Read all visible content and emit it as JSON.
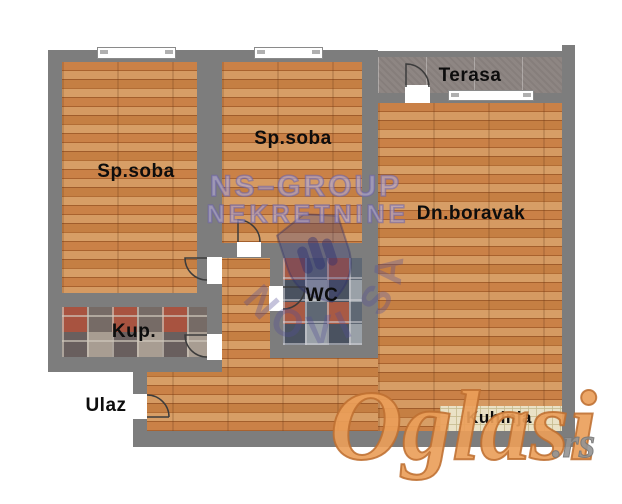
{
  "plan_title": "Apartment floor plan",
  "rooms": {
    "bedroom_left": "Sp.soba",
    "bedroom_middle": "Sp.soba",
    "terrace": "Terasa",
    "living_room": "Dn.boravak",
    "wc": "WC",
    "bathroom": "Kup.",
    "entrance": "Ulaz",
    "kitchen": "Kuhinja"
  },
  "watermarks": {
    "agency_name": "NS–GROUP",
    "agency_type": "NEKRETNINE",
    "agency_city": "NOVI SAD",
    "site_name": "Oglasi",
    "site_domain": ".rs"
  },
  "colors": {
    "wall": "#7d7d7d",
    "wood_floor": "#c0793f",
    "terrace_tile": "#8d8480",
    "bathroom_tile_accent": "#a85340",
    "kitchen_tile": "#e9e1c4",
    "watermark_agency": "#6f66a8",
    "watermark_site": "#e9975c"
  }
}
